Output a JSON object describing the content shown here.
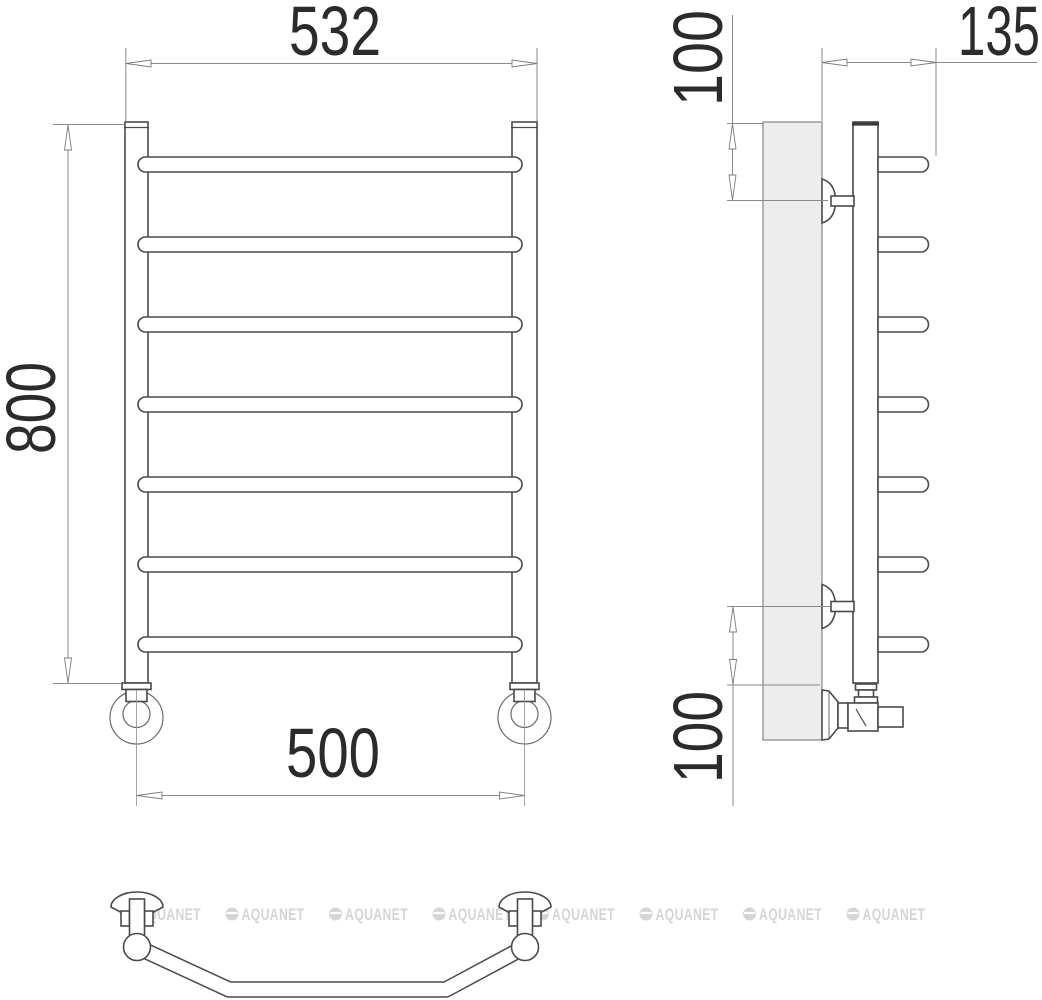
{
  "document": {
    "type": "technical-drawing",
    "subject": "wall-mounted ladder towel rail, three orthographic views"
  },
  "dimensions": {
    "front": {
      "overall_width": "532",
      "overall_height": "800",
      "mount_spacing": "500"
    },
    "side": {
      "depth": "135",
      "top_bracket_offset": "100",
      "bottom_bracket_offset": "100"
    }
  },
  "structure": {
    "rung_count": 7,
    "views": [
      "front",
      "side",
      "bottom"
    ]
  },
  "watermark": {
    "text": "AQUANET",
    "color": "#d5d5d5",
    "instances": 8
  },
  "colors": {
    "outline": "#4a4a4a",
    "dimension_lines": "#8a8a8a",
    "dimension_text": "#2b2b2b",
    "panel_fill": "#ededed",
    "background": "#ffffff"
  }
}
